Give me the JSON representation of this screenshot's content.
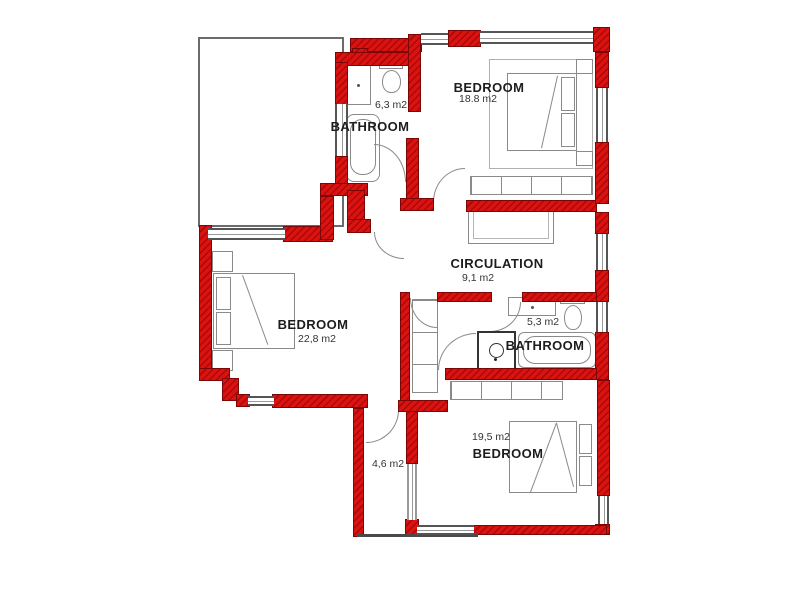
{
  "plan": {
    "type": "floor-plan",
    "colors": {
      "wall": "#dc1210",
      "wall_hatch": "#a80a0a",
      "furniture_line": "#8a8a8a",
      "text": "#1d1d1d"
    }
  },
  "rooms": {
    "bathroom_top": {
      "name": "BATHROOM",
      "area": "6,3 m2"
    },
    "bedroom_top": {
      "name": "BEDROOM",
      "area": "18.8 m2"
    },
    "circulation": {
      "name": "CIRCULATION",
      "area": "9,1 m2"
    },
    "bedroom_left": {
      "name": "BEDROOM",
      "area": "22,8 m2"
    },
    "bathroom_mid": {
      "name": "BATHROOM",
      "area": "5,3 m2"
    },
    "bedroom_bottom": {
      "name": "BEDROOM",
      "area": "19,5 m2"
    },
    "hall": {
      "area": "4,6 m2"
    }
  }
}
